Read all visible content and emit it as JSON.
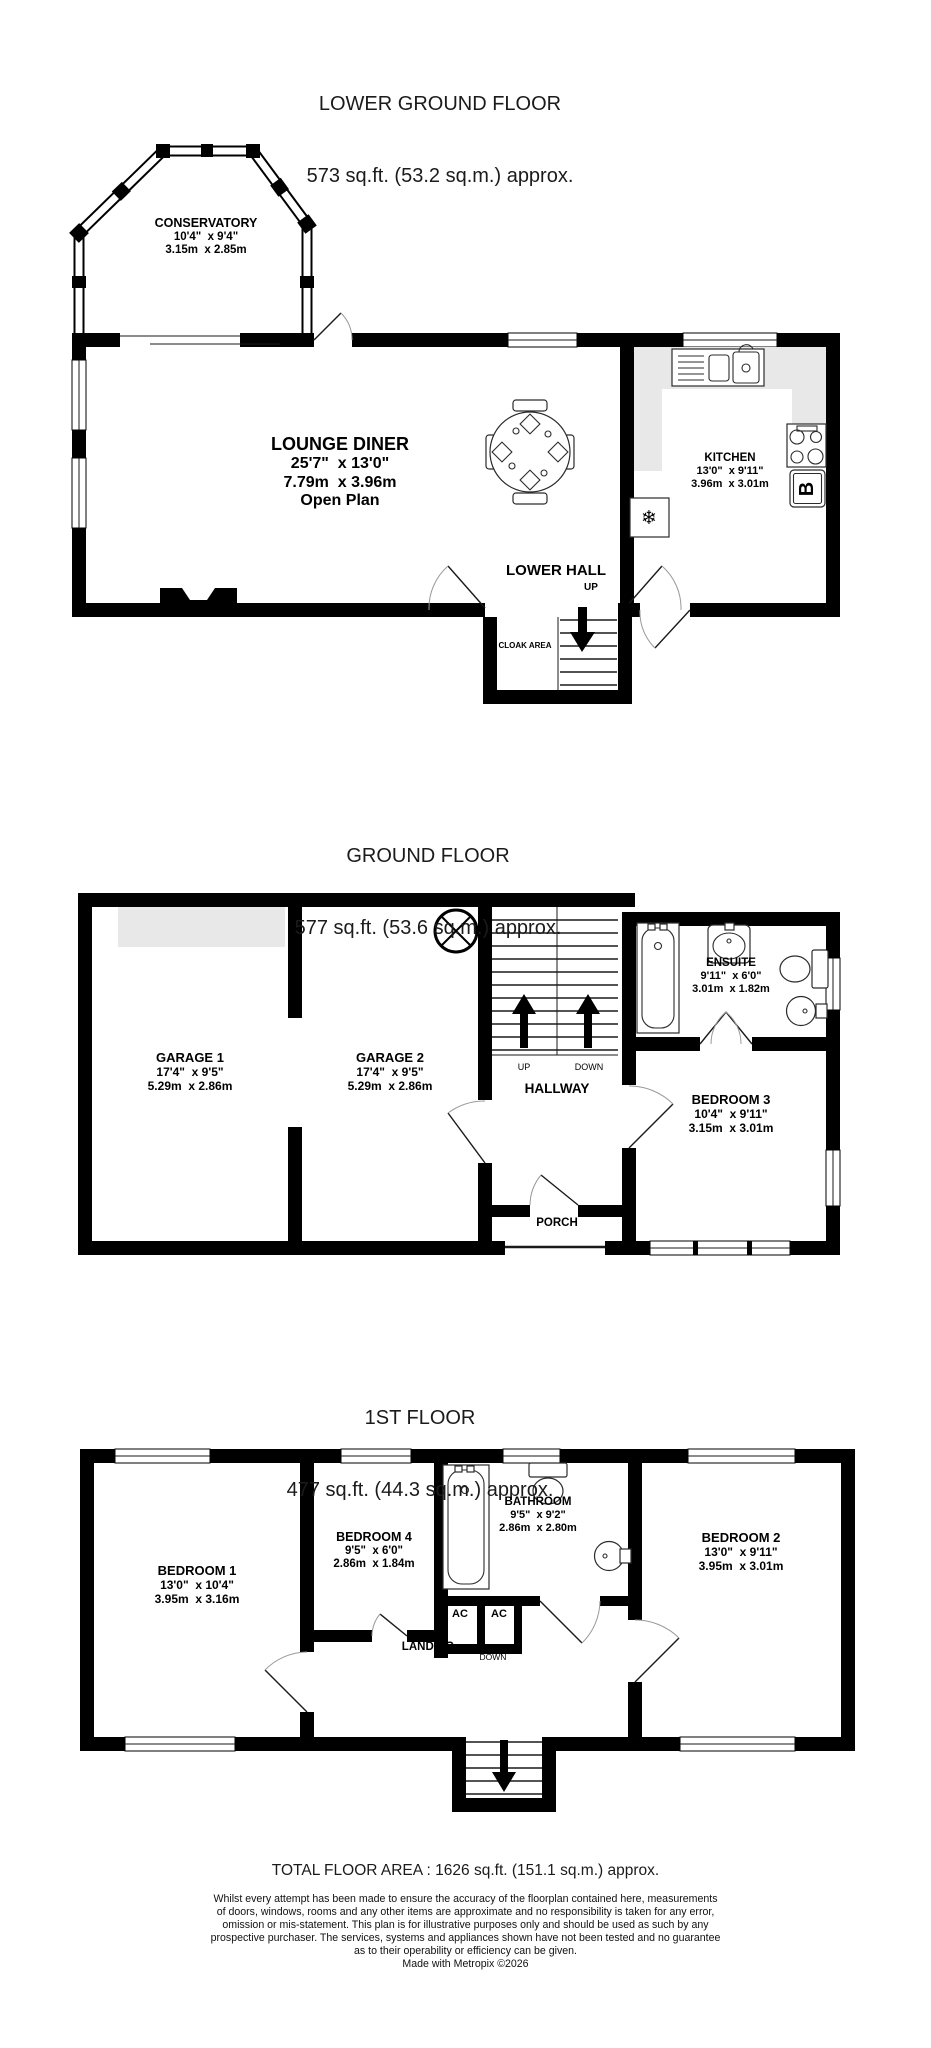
{
  "floors": [
    {
      "id": "lower-ground",
      "title": "LOWER GROUND FLOOR",
      "subtitle": "573 sq.ft. (53.2 sq.m.) approx.",
      "labels": {
        "conservatory": {
          "name": "CONSERVATORY",
          "imperial": "10'4\"  x 9'4\"",
          "metric": "3.15m  x 2.85m"
        },
        "lounge_diner": {
          "name": "LOUNGE DINER",
          "imperial": "25'7\"  x 13'0\"",
          "metric": "7.79m  x 3.96m",
          "note": "Open Plan"
        },
        "kitchen": {
          "name": "KITCHEN",
          "imperial": "13'0\"  x 9'11\"",
          "metric": "3.96m  x 3.01m"
        },
        "lower_hall": "LOWER HALL",
        "up": "UP",
        "cloak_area": "CLOAK AREA",
        "boiler": "B",
        "freezer_icon": "❄"
      }
    },
    {
      "id": "ground",
      "title": "GROUND FLOOR",
      "subtitle": "577 sq.ft. (53.6 sq.m.) approx.",
      "labels": {
        "garage1": {
          "name": "GARAGE 1",
          "imperial": "17'4\"  x 9'5\"",
          "metric": "5.29m  x 2.86m"
        },
        "garage2": {
          "name": "GARAGE 2",
          "imperial": "17'4\"  x 9'5\"",
          "metric": "5.29m  x 2.86m"
        },
        "ensuite": {
          "name": "ENSUITE",
          "imperial": "9'11\"  x 6'0\"",
          "metric": "3.01m  x 1.82m"
        },
        "bedroom3": {
          "name": "BEDROOM 3",
          "imperial": "10'4\"  x 9'11\"",
          "metric": "3.15m  x 3.01m"
        },
        "hallway": "HALLWAY",
        "porch": "PORCH",
        "up": "UP",
        "down": "DOWN"
      }
    },
    {
      "id": "first",
      "title": "1ST FLOOR",
      "subtitle": "477 sq.ft. (44.3 sq.m.) approx.",
      "labels": {
        "bedroom1": {
          "name": "BEDROOM 1",
          "imperial": "13'0\"  x 10'4\"",
          "metric": "3.95m  x 3.16m"
        },
        "bedroom4": {
          "name": "BEDROOM 4",
          "imperial": "9'5\"  x 6'0\"",
          "metric": "2.86m  x 1.84m"
        },
        "bathroom": {
          "name": "BATHROOM",
          "imperial": "9'5\"  x 9'2\"",
          "metric": "2.86m  x 2.80m"
        },
        "bedroom2": {
          "name": "BEDROOM 2",
          "imperial": "13'0\"  x 9'11\"",
          "metric": "3.95m  x 3.01m"
        },
        "landing": "LANDING",
        "down": "DOWN",
        "ac_left": "AC",
        "ac_right": "AC"
      }
    }
  ],
  "footer": {
    "total_area": "TOTAL FLOOR AREA : 1626 sq.ft. (151.1 sq.m.) approx.",
    "disclaimer_lines": [
      "Whilst every attempt has been made to ensure the accuracy of the floorplan contained here, measurements",
      "of doors, windows, rooms and any other items are approximate and no responsibility is taken for any error,",
      "omission or mis-statement. This plan is for illustrative purposes only and should be used as such by any",
      "prospective purchaser. The services, systems and appliances shown have not been tested and no guarantee",
      "as to their operability or efficiency can be given."
    ],
    "credit": "Made with Metropix ©2026"
  }
}
